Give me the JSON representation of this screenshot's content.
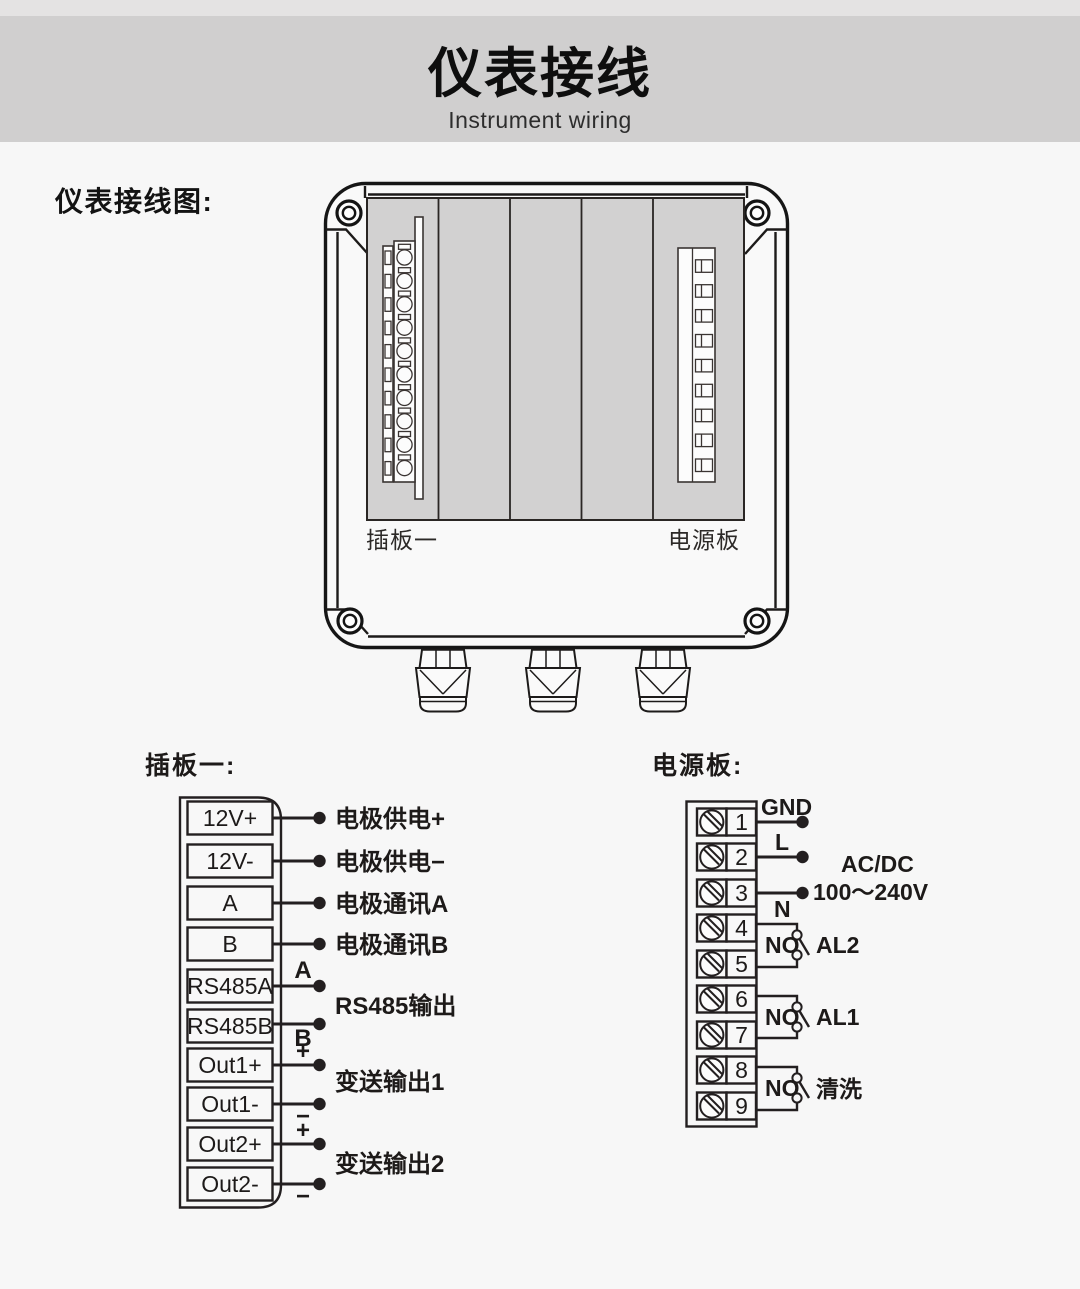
{
  "header": {
    "title": "仪表接线",
    "subtitle": "Instrument wiring"
  },
  "section_label": "仪表接线图:",
  "colors": {
    "background": "#f7f7f7",
    "top_strip": "#e4e3e3",
    "header_band": "#d0cfcf",
    "panel_gray": "#d2d1d1",
    "line": "#231f20"
  },
  "device": {
    "left_board_label": "插板一",
    "right_board_label": "电源板"
  },
  "board1": {
    "heading": "插板一:",
    "terminals": [
      "12V+",
      "12V-",
      "A",
      "B",
      "RS485A",
      "RS485B",
      "Out1+",
      "Out1-",
      "Out2+",
      "Out2-"
    ],
    "wire_labels": [
      "电极供电+",
      "电极供电−",
      "电极通讯A",
      "电极通讯B"
    ],
    "rs485": {
      "a": "A",
      "b": "B",
      "label": "RS485输出"
    },
    "out1": {
      "plus": "+",
      "minus": "−",
      "label": "变送输出1"
    },
    "out2": {
      "plus": "+",
      "minus": "−",
      "label": "变送输出2"
    }
  },
  "board2": {
    "heading": "电源板:",
    "numbers": [
      "1",
      "2",
      "3",
      "4",
      "5",
      "6",
      "7",
      "8",
      "9"
    ],
    "gnd": "GND",
    "live": "L",
    "neutral": "N",
    "acdc": "AC/DC",
    "voltage": "100～240V",
    "relays": [
      {
        "no": "NO",
        "label": "AL2"
      },
      {
        "no": "NO",
        "label": "AL1"
      },
      {
        "no": "NO",
        "label": "清洗"
      }
    ]
  }
}
